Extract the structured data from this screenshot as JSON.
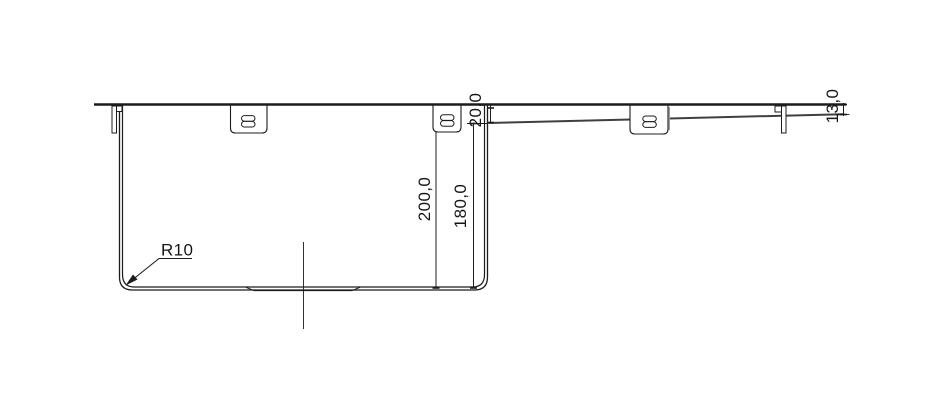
{
  "drawing": {
    "background": "#ffffff",
    "line_color": "#1c1c1c",
    "labels": {
      "depth_total": "200,0",
      "depth_inner": "180,0",
      "step_depth": "20,0",
      "edge_height": "13,0",
      "corner_radius": "R10"
    }
  }
}
